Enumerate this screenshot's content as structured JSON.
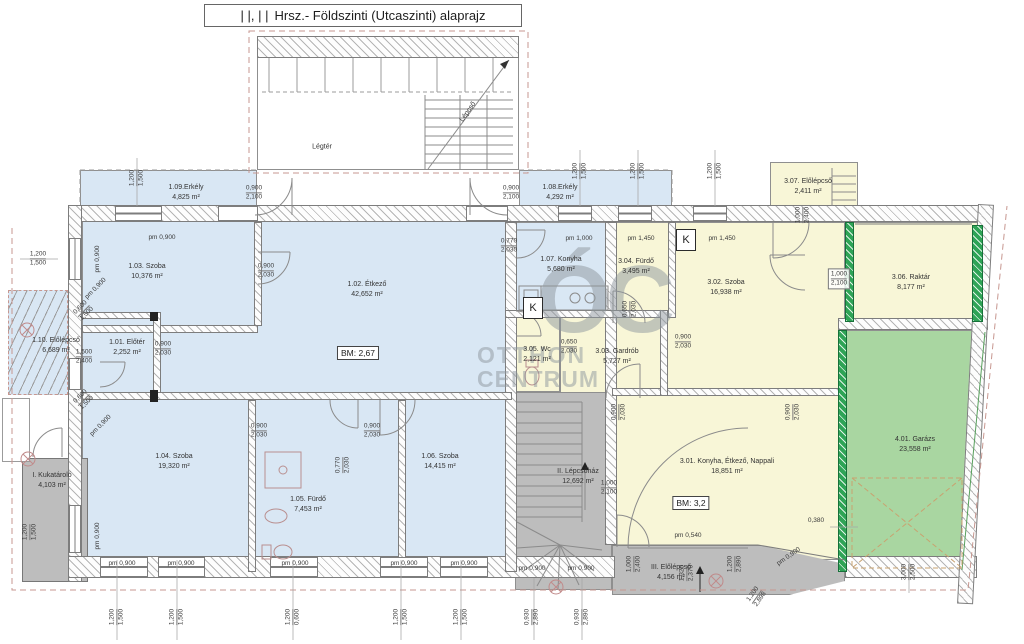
{
  "title": {
    "marks": "| |, | |",
    "text": "Hrsz.- Földszinti (Utcaszinti) alaprajz"
  },
  "watermark": {
    "monogram": "ÓC",
    "line1": "OTTHON",
    "line2": "CENTRUM"
  },
  "annotations": {
    "legter": "Légtér",
    "lepcso": "Lépcső",
    "bm_left": "BM: 2,67",
    "bm_right": "BM: 3,2",
    "k": "K"
  },
  "colors": {
    "room_blue": "#d9e7f4",
    "room_yellow": "#f8f6d7",
    "room_green": "#a9d6a1",
    "wall_green": "#2fa456",
    "stairs_gray": "#bdbdbd",
    "boundary_dash": "#c79790"
  },
  "rooms": [
    {
      "l1": "1.01. Előtér",
      "l2": "2,252 m²"
    },
    {
      "l1": "1.02. Étkező",
      "l2": "42,652 m²"
    },
    {
      "l1": "1.03. Szoba",
      "l2": "10,376 m²"
    },
    {
      "l1": "1.04. Szoba",
      "l2": "19,320 m²"
    },
    {
      "l1": "1.05. Fürdő",
      "l2": "7,453 m²"
    },
    {
      "l1": "1.06. Szoba",
      "l2": "14,415 m²"
    },
    {
      "l1": "1.07. Konyha",
      "l2": "5,680 m²"
    },
    {
      "l1": "1.08.Erkély",
      "l2": "4,292 m²"
    },
    {
      "l1": "1.09.Erkély",
      "l2": "4,825 m²"
    },
    {
      "l1": "1.10. Előlépcső",
      "l2": "6,689 m²"
    },
    {
      "l1": "I. Kukatároló",
      "l2": "4,103 m²"
    },
    {
      "l1": "II. Lépcsőház",
      "l2": "12,692 m²"
    },
    {
      "l1": "III. Előlépcső",
      "l2": "4,156 m²"
    },
    {
      "l1": "3.01. Konyha, Étkező, Nappali",
      "l2": "18,851 m²"
    },
    {
      "l1": "3.02. Szoba",
      "l2": "16,938 m²"
    },
    {
      "l1": "3.03. Gardrób",
      "l2": "5,727 m²"
    },
    {
      "l1": "3.04. Fürdő",
      "l2": "3,495 m²"
    },
    {
      "l1": "3.05. Wc",
      "l2": "2,121 m²"
    },
    {
      "l1": "3.06. Raktár",
      "l2": "8,177 m²"
    },
    {
      "l1": "3.07. Előlépcső",
      "l2": "2,411 m²"
    },
    {
      "l1": "4.01. Garázs",
      "l2": "23,558 m²"
    }
  ],
  "dims": [
    {
      "a": "1,200",
      "b": "1,500"
    },
    {
      "a": "1,200",
      "b": "1,500"
    },
    {
      "a": "0,900",
      "b": "2,100"
    },
    {
      "a": "pm 0,900"
    },
    {
      "a": "pm 0,900"
    },
    {
      "a": "pm 0,900"
    },
    {
      "a": "0,600",
      "b": "1,500"
    },
    {
      "a": "0,900",
      "b": "2,030"
    },
    {
      "a": "1,500",
      "b": "2,400"
    },
    {
      "a": "0,900",
      "b": "2,030"
    },
    {
      "a": "0,600",
      "b": "1,500"
    },
    {
      "a": "pm 0,900"
    },
    {
      "a": "0,900",
      "b": "2,030"
    },
    {
      "a": "0,900",
      "b": "2,030"
    },
    {
      "a": "0,770",
      "b": "2,030"
    },
    {
      "a": "pm 0,900"
    },
    {
      "a": "pm 0,900"
    },
    {
      "a": "pm 0,900"
    },
    {
      "a": "pm 0,900"
    },
    {
      "a": "pm 0,900"
    },
    {
      "a": "pm 0,900"
    },
    {
      "a": "0,900",
      "b": "2,100"
    },
    {
      "a": "1,200",
      "b": "1,500"
    },
    {
      "a": "1,200",
      "b": "1,500"
    },
    {
      "a": "1,200",
      "b": "1,500"
    },
    {
      "a": "0,770",
      "b": "2,030"
    },
    {
      "a": "pm 1,000"
    },
    {
      "a": "pm 1,450"
    },
    {
      "a": "pm 1,450"
    },
    {
      "a": "0,650",
      "b": "2,030"
    },
    {
      "a": "0,650",
      "b": "2,030"
    },
    {
      "a": "0,900",
      "b": "2,030"
    },
    {
      "a": "1,000",
      "b": "2,400"
    },
    {
      "a": "1,000",
      "b": "2,100"
    },
    {
      "a": "0,900",
      "b": "2,030"
    },
    {
      "a": "0,900",
      "b": "2,030"
    },
    {
      "a": "1,000",
      "b": "2,100"
    },
    {
      "a": "pm 0,540"
    },
    {
      "a": "0,380"
    },
    {
      "a": "pm 0,900"
    },
    {
      "a": "1,000",
      "b": "2,400"
    },
    {
      "a": "1,320",
      "b": "2,370"
    },
    {
      "a": "1,200",
      "b": "2,890"
    },
    {
      "a": "1,200",
      "b": "2,898"
    },
    {
      "a": "0,930",
      "b": "2,890"
    },
    {
      "a": "0,930",
      "b": "2,890"
    },
    {
      "a": "1,200",
      "b": "1,500"
    },
    {
      "a": "1,200",
      "b": "1,500"
    },
    {
      "a": "1,200",
      "b": "0,600"
    },
    {
      "a": "1,200",
      "b": "1,500"
    },
    {
      "a": "1,200",
      "b": "1,500"
    },
    {
      "a": "3,000",
      "b": "2,500"
    },
    {
      "a": "pm 0,900"
    },
    {
      "a": "pm 0,900"
    },
    {
      "a": "1,200",
      "b": "1,500"
    }
  ]
}
